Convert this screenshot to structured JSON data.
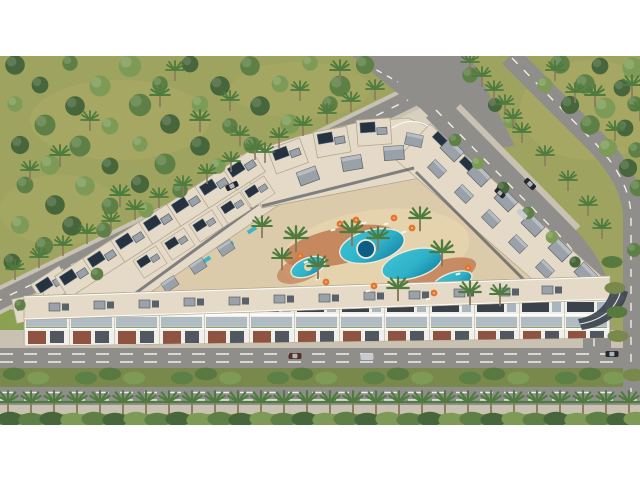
{
  "meta": {
    "title": "Aerial 3D architectural rendering of a residential resort complex with lagoon pools, surrounded by tree groves and boulevards",
    "image_kind": "computer-generated architectural visualization, bird's-eye view",
    "letterbox": "white bands at top and bottom of the frame"
  },
  "scene": {
    "site": "V-shaped low-rise apartment/villa complex enclosing a central courtyard",
    "courtyard": "sandy deck with winding terracotta paths, kidney-shaped turquoise lagoon pool, round spa pool, three satellite pools, palm trees, sun loungers and orange parasols",
    "buildings": "white flat-roofed blocks with cream roof terraces, rooftop solar panels, grey stair/elevator boxes, glass balconies and brick-red ground-floor accents",
    "roads": "diagonal road along the north-west side, dual-carriageway avenue with palm median along the north-east side meeting a wide junction at top, and a horizontal boulevard with planted median, palm-lined promenade and hedge at the bottom",
    "vegetation": "dense groves of round trees and slim palms on yellow-green grass at upper left and upper right",
    "vehicles": "a few dark and silver cars travelling and parked along the roads"
  },
  "object_counts": {
    "grove_trees": 60,
    "palms": 70,
    "median_bushes": 31,
    "hedge_bushes": 31,
    "villa_solar_roofs": 18,
    "grey_roof_boxes": 26,
    "pools": 5,
    "parasols": 9,
    "loungers": 10,
    "cars": 7
  },
  "colors": {
    "white": "#ffffff",
    "grass": "#9ea45f",
    "grass_light": "#b4ae6a",
    "tree_dark": "#47663b",
    "tree_mid": "#5e8046",
    "tree_light": "#7d9b57",
    "palm": "#4e7b3e",
    "trunk": "#8b7b5c",
    "asphalt": "#8f8e8a",
    "road_line": "#f4f3ee",
    "sidewalk": "#c9c2b3",
    "plot": "#d8d0bf",
    "roof": "#e4dac7",
    "roof_edge": "#b3a78f",
    "solar": "#27323f",
    "solar_line": "#547394",
    "box": "#9aa1a9",
    "box_dark": "#59616a",
    "facade": "#f1efe9",
    "window": "#3a424c",
    "glass": "#a9b6c0",
    "brick": "#8f5441",
    "deck": "#dccbaa",
    "sand": "#e6d4ad",
    "terracotta": "#c07a51",
    "pool": "#2fb2c9",
    "pool_deep": "#0f7da0",
    "spa": "#0c5e86",
    "rim": "#efe9d9",
    "umbrella": "#e2772e",
    "lounger": "#f7f5ef",
    "car_dark": "#22272d",
    "car_silver": "#c8cbcd",
    "car_red": "#55302a",
    "median": "#79894b",
    "hedge": "#587a41",
    "lawn": "#8aa151"
  }
}
